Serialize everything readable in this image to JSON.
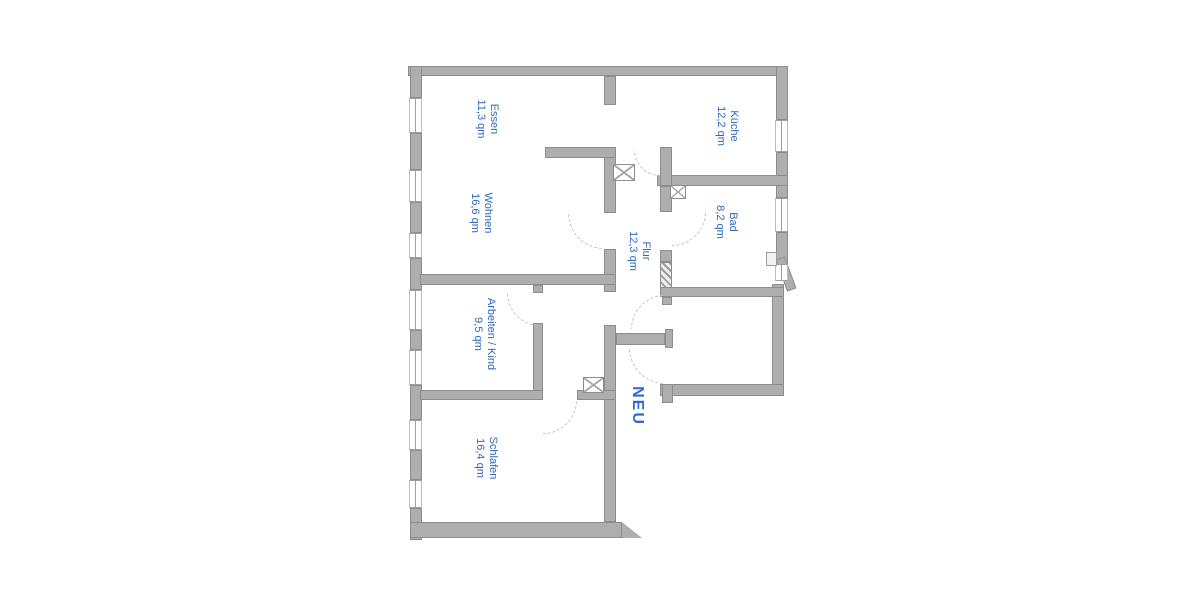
{
  "colors": {
    "wall_fill": "#aeaeae",
    "wall_edge": "#8d8d8d",
    "label_blue": "#3069b8",
    "neu_blue": "#3468cf",
    "door_arc": "#c3c3c3",
    "background": "#ffffff"
  },
  "plan": {
    "rooms": [
      {
        "id": "essen",
        "label": "Essen",
        "area": "11,3 qm",
        "cx": 486,
        "cy": 119,
        "cls": ""
      },
      {
        "id": "wohnen",
        "label": "Wohnen",
        "area": "16,6 qm",
        "cx": 480,
        "cy": 213,
        "cls": ""
      },
      {
        "id": "kueche",
        "label": "Küche",
        "area": "12,2 qm",
        "cx": 726,
        "cy": 126,
        "cls": ""
      },
      {
        "id": "bad",
        "label": "Bad",
        "area": "8,2 qm",
        "cx": 725,
        "cy": 222,
        "cls": ""
      },
      {
        "id": "flur",
        "label": "Flur",
        "area": "12,3 qm",
        "cx": 638,
        "cy": 251,
        "cls": ""
      },
      {
        "id": "arbeiten",
        "label": "Arbeiten / Kind",
        "area": "9,5 qm",
        "cx": 483,
        "cy": 334,
        "cls": ""
      },
      {
        "id": "schlafen",
        "label": "Schlafen",
        "area": "16,4 qm",
        "cx": 485,
        "cy": 458,
        "cls": ""
      },
      {
        "id": "neu",
        "label": "NEU",
        "area": "",
        "cx": 636,
        "cy": 406,
        "cls": "neu"
      }
    ],
    "walls": [
      {
        "id": "top-exterior",
        "x": 408,
        "y": 66,
        "w": 380,
        "h": 10
      },
      {
        "id": "left-exterior-1",
        "x": 410,
        "y": 66,
        "w": 12,
        "h": 32
      },
      {
        "id": "left-exterior-2",
        "x": 410,
        "y": 133,
        "w": 12,
        "h": 37
      },
      {
        "id": "left-exterior-3",
        "x": 410,
        "y": 202,
        "w": 12,
        "h": 31
      },
      {
        "id": "left-exterior-4",
        "x": 410,
        "y": 258,
        "w": 12,
        "h": 32
      },
      {
        "id": "left-exterior-5",
        "x": 410,
        "y": 330,
        "w": 12,
        "h": 20
      },
      {
        "id": "left-exterior-6",
        "x": 410,
        "y": 385,
        "w": 12,
        "h": 35
      },
      {
        "id": "left-exterior-7",
        "x": 410,
        "y": 450,
        "w": 12,
        "h": 30
      },
      {
        "id": "left-exterior-8",
        "x": 410,
        "y": 508,
        "w": 12,
        "h": 32
      },
      {
        "id": "bottom-exterior",
        "x": 410,
        "y": 522,
        "w": 212,
        "h": 16
      },
      {
        "id": "bottom-exterior-flare",
        "x": 622,
        "y": 522,
        "w": 20,
        "h": 16,
        "clip": "polygon(0 0, 100% 100%, 0 100%)"
      },
      {
        "id": "right-exterior-1",
        "x": 776,
        "y": 66,
        "w": 12,
        "h": 54
      },
      {
        "id": "right-exterior-2",
        "x": 776,
        "y": 152,
        "w": 12,
        "h": 46
      },
      {
        "id": "right-exterior-3",
        "x": 776,
        "y": 232,
        "w": 12,
        "h": 32
      },
      {
        "id": "right-exterior-chamfer",
        "x": 781,
        "y": 257,
        "w": 10,
        "h": 34,
        "rot": -20
      },
      {
        "id": "right-room-right",
        "x": 772,
        "y": 284,
        "w": 12,
        "h": 110
      },
      {
        "id": "kueche-bad-divider",
        "x": 657,
        "y": 175,
        "w": 131,
        "h": 11
      },
      {
        "id": "kueche-left",
        "x": 660,
        "y": 147,
        "w": 12,
        "h": 39
      },
      {
        "id": "bad-left-upper",
        "x": 660,
        "y": 186,
        "w": 12,
        "h": 26
      },
      {
        "id": "bad-left-mid",
        "x": 660,
        "y": 250,
        "w": 12,
        "h": 12
      },
      {
        "id": "bad-left-new",
        "x": 660,
        "y": 262,
        "w": 12,
        "h": 28,
        "hatched": true
      },
      {
        "id": "bad-bottom",
        "x": 660,
        "y": 287,
        "w": 124,
        "h": 10
      },
      {
        "id": "right-room-bottom",
        "x": 660,
        "y": 384,
        "w": 124,
        "h": 12
      },
      {
        "id": "right-room-stub-top",
        "x": 662,
        "y": 297,
        "w": 10,
        "h": 8
      },
      {
        "id": "right-room-jamb",
        "x": 665,
        "y": 329,
        "w": 8,
        "h": 19
      },
      {
        "id": "right-room-stub-bottom",
        "x": 662,
        "y": 384,
        "w": 11,
        "h": 19
      },
      {
        "id": "flur-t-stub",
        "x": 616,
        "y": 333,
        "w": 49,
        "h": 12
      },
      {
        "id": "central-1",
        "x": 604,
        "y": 76,
        "w": 12,
        "h": 29
      },
      {
        "id": "central-2",
        "x": 604,
        "y": 147,
        "w": 12,
        "h": 66
      },
      {
        "id": "central-3",
        "x": 604,
        "y": 249,
        "w": 12,
        "h": 43
      },
      {
        "id": "central-4",
        "x": 604,
        "y": 325,
        "w": 12,
        "h": 197
      },
      {
        "id": "essen-wohnen-divider",
        "x": 545,
        "y": 147,
        "w": 71,
        "h": 11
      },
      {
        "id": "arbeiten-top",
        "x": 420,
        "y": 274,
        "w": 196,
        "h": 11
      },
      {
        "id": "arbeiten-right-stub",
        "x": 533,
        "y": 285,
        "w": 10,
        "h": 8
      },
      {
        "id": "arbeiten-right",
        "x": 533,
        "y": 323,
        "w": 10,
        "h": 77
      },
      {
        "id": "schlafen-top-left",
        "x": 420,
        "y": 390,
        "w": 123,
        "h": 10
      },
      {
        "id": "schlafen-top-right",
        "x": 577,
        "y": 390,
        "w": 39,
        "h": 10
      }
    ],
    "windows": [
      {
        "x": 409,
        "y": 98,
        "w": 13,
        "h": 35
      },
      {
        "x": 409,
        "y": 170,
        "w": 13,
        "h": 32
      },
      {
        "x": 409,
        "y": 233,
        "w": 13,
        "h": 25
      },
      {
        "x": 409,
        "y": 290,
        "w": 13,
        "h": 40
      },
      {
        "x": 409,
        "y": 350,
        "w": 13,
        "h": 35
      },
      {
        "x": 409,
        "y": 420,
        "w": 13,
        "h": 30
      },
      {
        "x": 409,
        "y": 480,
        "w": 13,
        "h": 28
      },
      {
        "x": 775,
        "y": 120,
        "w": 13,
        "h": 32
      },
      {
        "x": 775,
        "y": 198,
        "w": 13,
        "h": 34
      },
      {
        "x": 775,
        "y": 264,
        "w": 13,
        "h": 17
      }
    ],
    "xboxes": [
      {
        "id": "shaft-flur-kueche",
        "x": 613,
        "y": 164,
        "w": 22,
        "h": 17
      },
      {
        "id": "shaft-bad",
        "x": 670,
        "y": 185,
        "w": 16,
        "h": 14
      },
      {
        "id": "shaft-schlafen",
        "x": 583,
        "y": 377,
        "w": 21,
        "h": 16
      }
    ],
    "vents": [
      {
        "id": "bad-vent",
        "x": 766,
        "y": 252,
        "w": 11,
        "h": 14
      }
    ],
    "doors": [
      {
        "id": "door-wohnen",
        "cx": 604,
        "cy": 213,
        "r": 36,
        "q": "bl"
      },
      {
        "id": "door-kueche",
        "cx": 660,
        "cy": 150,
        "r": 26,
        "q": "bl"
      },
      {
        "id": "door-bad",
        "cx": 672,
        "cy": 212,
        "r": 34,
        "q": "br"
      },
      {
        "id": "door-arbeiten",
        "cx": 540,
        "cy": 293,
        "r": 33,
        "q": "bl"
      },
      {
        "id": "door-schlafen",
        "cx": 543,
        "cy": 400,
        "r": 34,
        "q": "br"
      },
      {
        "id": "door-right-room-upper",
        "cx": 665,
        "cy": 329,
        "r": 34,
        "q": "tl"
      },
      {
        "id": "door-right-room-lower",
        "cx": 665,
        "cy": 348,
        "r": 36,
        "q": "bl"
      }
    ]
  }
}
